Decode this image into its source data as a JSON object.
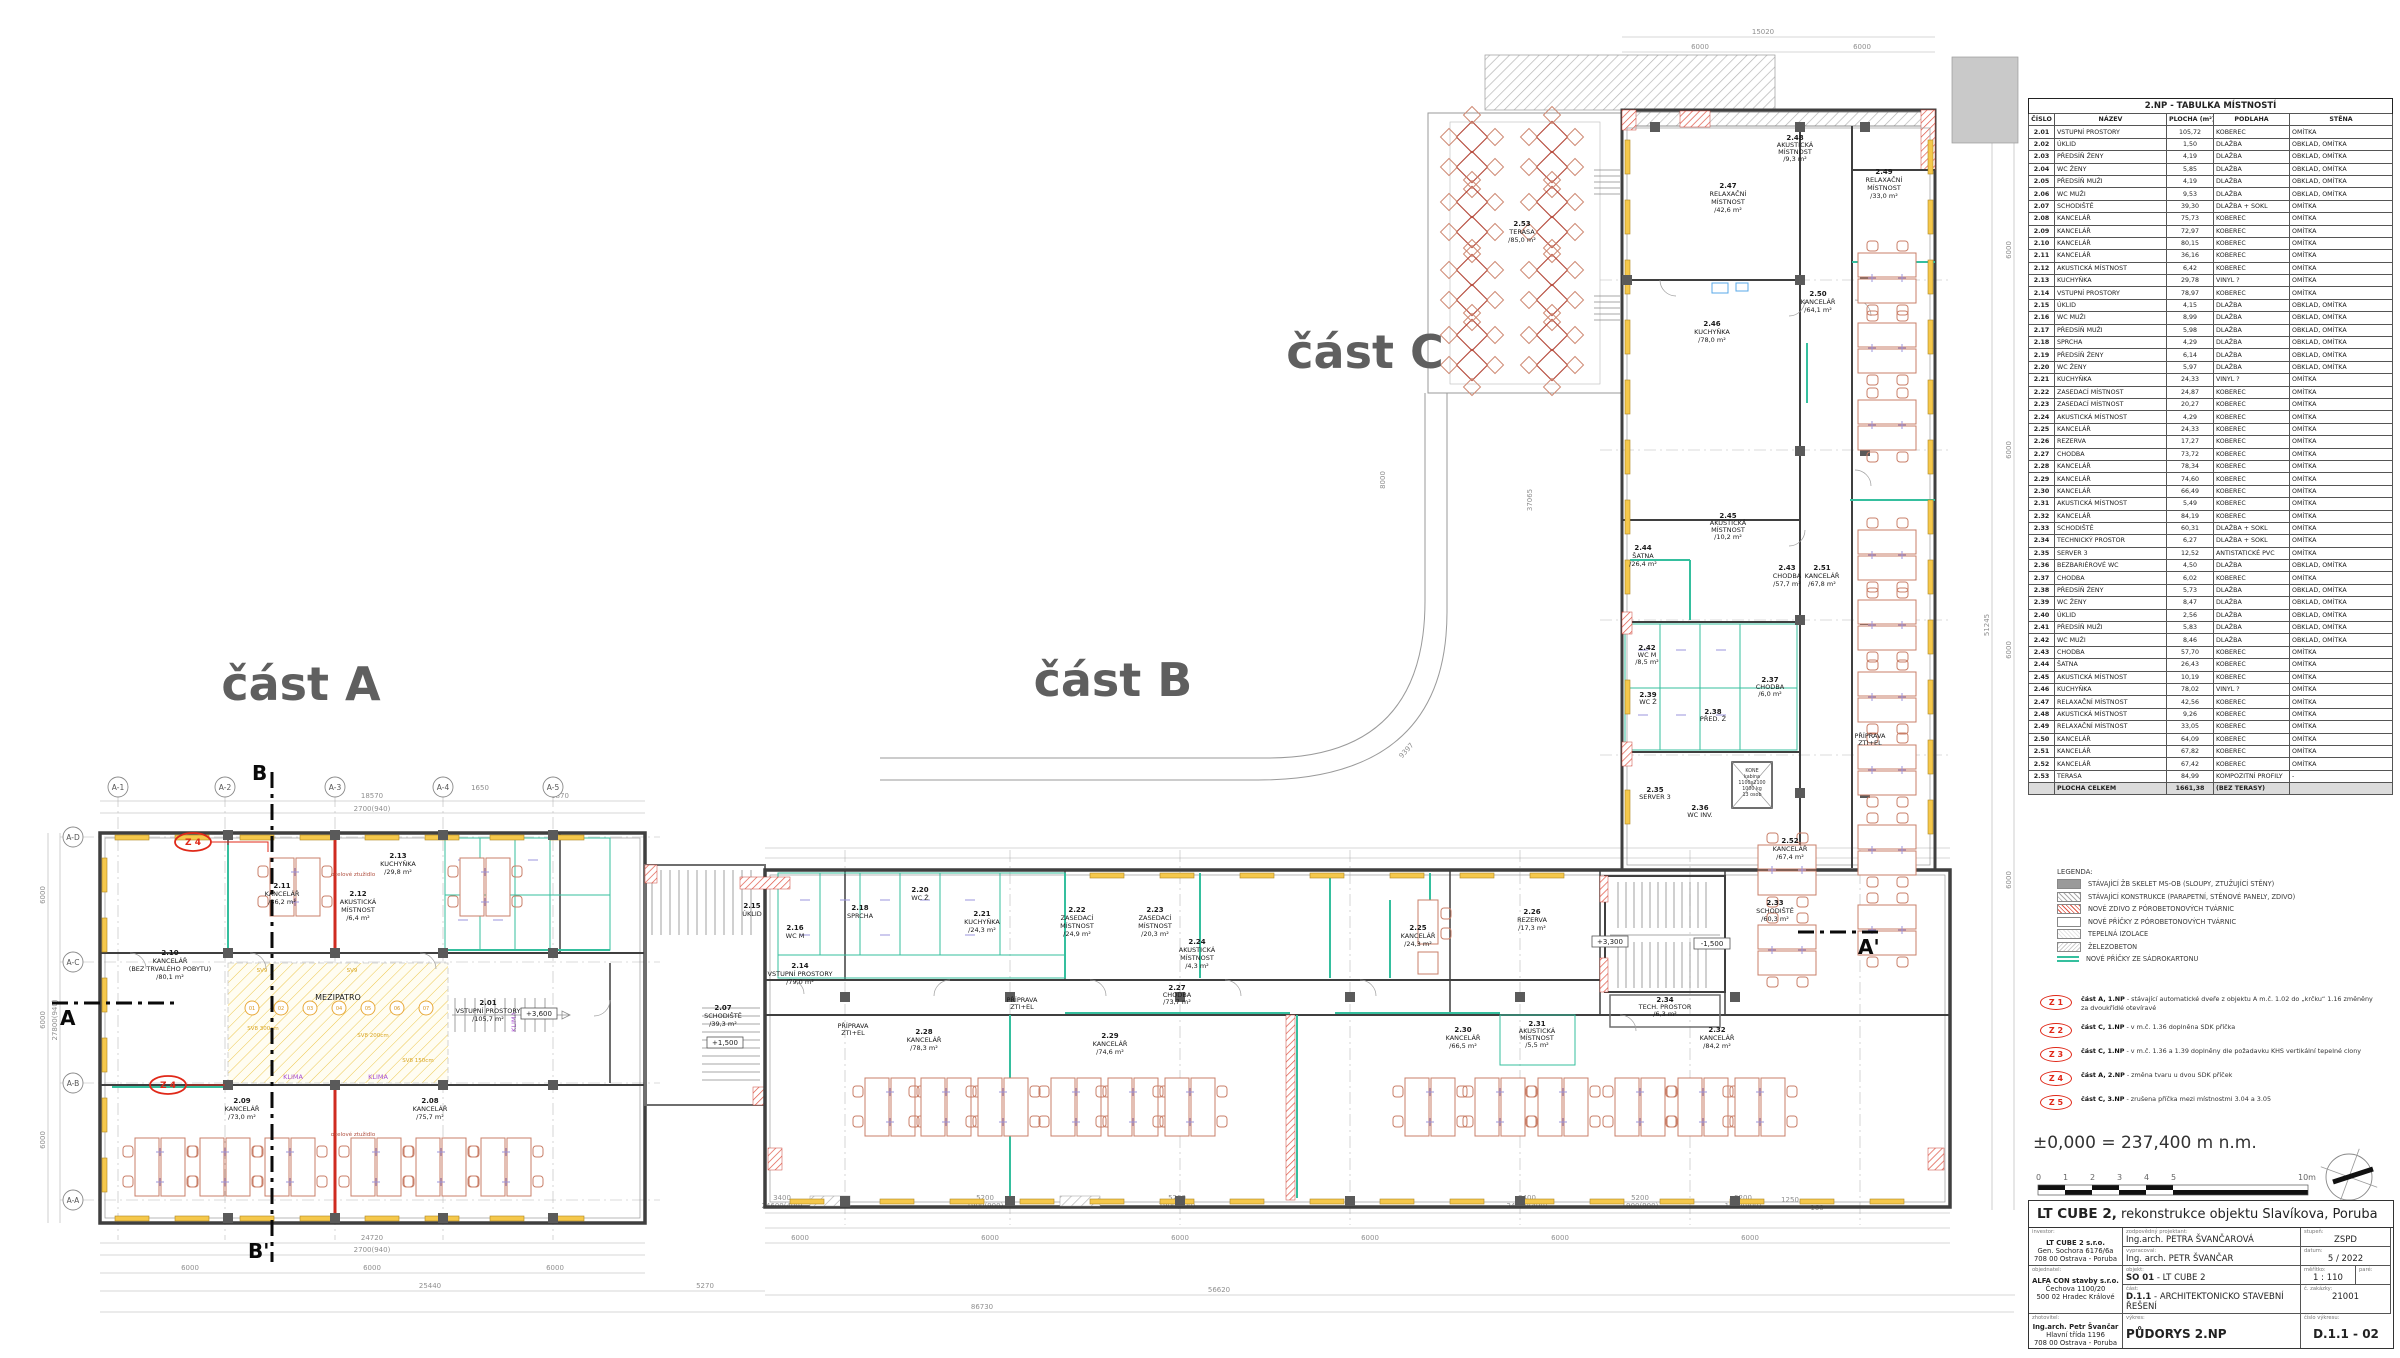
{
  "drawing_labels": {
    "part_a": "část A",
    "part_b": "část B",
    "part_c": "část C",
    "elevation_note": "±0,000 = 237,400 m n.m.",
    "section_a": "A",
    "section_a2": "A'",
    "section_b": "B",
    "section_b2": "B'",
    "level_3600": "+3,600",
    "level_1500": "+1,500",
    "level_3300": "+3,300",
    "level_m1500": "-1,500",
    "mezipatro": "MEZIPATRO",
    "klima": "KLIMA",
    "priprava1": "PŘÍPRAVA",
    "priprava2": "ZTI+EL",
    "steel_note": "ocelové ztužidlo",
    "kone": {
      "l1": "KONE",
      "l2": "kabina",
      "l3": "1100x2100",
      "l4": "1000 kg",
      "l5": "13 osob"
    }
  },
  "axes": {
    "top": [
      "A-1",
      "A-2",
      "A-3",
      "A-4",
      "A-5"
    ],
    "left": [
      "A-D",
      "A-C",
      "A-B",
      "A-A"
    ]
  },
  "dims": {
    "t1": "18570",
    "t2": "2700(940)",
    "t3": "6870",
    "t4": "1650",
    "l1": "27800(940)",
    "b1": "24720",
    "b2": "2700(940)",
    "six": "6000",
    "b3": "25440",
    "b4": "5270",
    "g1": "56620",
    "g2": "86730",
    "m1": "5200",
    "m2": "1900(900)",
    "m3": "3400",
    "m4": "24600(400)",
    "m5": "1250",
    "m6": "160",
    "c1": "15020",
    "c2": "51245",
    "r1": "8000",
    "r2": "37065",
    "r3": "9397"
  },
  "mez_nums": [
    "01",
    "02",
    "03",
    "04",
    "05",
    "06",
    "07"
  ],
  "sv_labels": [
    "SV9",
    "SV9",
    "SV8 150cm",
    "SV8 300cm",
    "SV8 200cm"
  ],
  "plan_rooms": {
    "r201": {
      "num": "2.01",
      "name": "VSTUPNÍ PROSTORY",
      "area": "/105,7 m²"
    },
    "r207": {
      "num": "2.07",
      "name": "SCHODIŠTĚ",
      "area": "/39,3 m²"
    },
    "r208": {
      "num": "2.08",
      "name": "KANCELÁŘ",
      "area": "/75,7 m²"
    },
    "r209": {
      "num": "2.09",
      "name": "KANCELÁŘ",
      "area": "/73,0 m²"
    },
    "r210": {
      "num": "2.10",
      "name": "KANCELÁŘ",
      "name2": "(BEZ TRVALÉHO POBYTU)",
      "area": "/80,1 m²"
    },
    "r211": {
      "num": "2.11",
      "name": "KANCELÁŘ",
      "area": "/36,2 m²"
    },
    "r212": {
      "num": "2.12",
      "name": "AKUSTICKÁ",
      "name2": "MÍSTNOST",
      "area": "/6,4 m²"
    },
    "r213": {
      "num": "2.13",
      "name": "KUCHYŇKA",
      "area": "/29,8 m²"
    },
    "r214": {
      "num": "2.14",
      "name": "VSTUPNÍ PROSTORY",
      "area": "/79,0 m²"
    },
    "r215": {
      "num": "2.15",
      "name": "ÚKLID"
    },
    "r216": {
      "num": "2.16",
      "name": "WC M",
      "area": "/9,0 m²"
    },
    "r218": {
      "num": "2.18",
      "name": "SPRCHA",
      "area": "/4,3 m²"
    },
    "r220": {
      "num": "2.20",
      "name": "WC Ž",
      "area": "/6,0 m²"
    },
    "r221": {
      "num": "2.21",
      "name": "KUCHYŇKA",
      "area": "/24,3 m²"
    },
    "r222": {
      "num": "2.22",
      "name": "ZASEDACÍ",
      "name2": "MÍSTNOST",
      "area": "/24,9 m²"
    },
    "r223": {
      "num": "2.23",
      "name": "ZASEDACÍ",
      "name2": "MÍSTNOST",
      "area": "/20,3 m²"
    },
    "r224": {
      "num": "2.24",
      "name": "AKUSTICKÁ",
      "name2": "MÍSTNOST",
      "area": "/4,3 m²"
    },
    "r225": {
      "num": "2.25",
      "name": "KANCELÁŘ",
      "area": "/24,3 m²"
    },
    "r226": {
      "num": "2.26",
      "name": "REZERVA",
      "area": "/17,3 m²"
    },
    "r227": {
      "num": "2.27",
      "name": "CHODBA",
      "area": "/73,7 m²"
    },
    "r228": {
      "num": "2.28",
      "name": "KANCELÁŘ",
      "area": "/78,3 m²"
    },
    "r229": {
      "num": "2.29",
      "name": "KANCELÁŘ",
      "area": "/74,6 m²"
    },
    "r230": {
      "num": "2.30",
      "name": "KANCELÁŘ",
      "area": "/66,5 m²"
    },
    "r231": {
      "num": "2.31",
      "name": "AKUSTICKÁ",
      "name2": "MÍSTNOST",
      "area": "/5,5 m²"
    },
    "r232": {
      "num": "2.32",
      "name": "KANCELÁŘ",
      "area": "/84,2 m²"
    },
    "r233": {
      "num": "2.33",
      "name": "SCHODIŠTĚ",
      "area": "/60,3 m²"
    },
    "r234": {
      "num": "2.34",
      "name": "TECH. PROSTOR",
      "area": "/6,3 m²"
    },
    "r235": {
      "num": "2.35",
      "name": "SERVER 3"
    },
    "r236": {
      "num": "2.36",
      "name": "WC INV."
    },
    "r237": {
      "num": "2.37",
      "name": "CHODBA",
      "area": "/6,0 m²"
    },
    "r238": {
      "num": "2.38",
      "name": "PŘED. Ž"
    },
    "r239": {
      "num": "2.39",
      "name": "WC Ž"
    },
    "r242": {
      "num": "2.42",
      "name": "WC M",
      "area": "/8,5 m²"
    },
    "r243": {
      "num": "2.43",
      "name": "CHODBA",
      "area": "/57,7 m²"
    },
    "r244": {
      "num": "2.44",
      "name": "ŠATNA",
      "area": "/26,4 m²"
    },
    "r245": {
      "num": "2.45",
      "name": "AKUSTICKÁ",
      "name2": "MÍSTNOST",
      "area": "/10,2 m²"
    },
    "r246": {
      "num": "2.46",
      "name": "KUCHYŇKA",
      "area": "/78,0 m²"
    },
    "r247": {
      "num": "2.47",
      "name": "RELAXAČNÍ",
      "name2": "MÍSTNOST",
      "area": "/42,6 m²"
    },
    "r248": {
      "num": "2.48",
      "name": "AKUSTICKÁ",
      "name2": "MÍSTNOST",
      "area": "/9,3 m²"
    },
    "r249": {
      "num": "2.49",
      "name": "RELAXAČNÍ",
      "name2": "MÍSTNOST",
      "area": "/33,0 m²"
    },
    "r250": {
      "num": "2.50",
      "name": "KANCELÁŘ",
      "area": "/64,1 m²"
    },
    "r251": {
      "num": "2.51",
      "name": "KANCELÁŘ",
      "area": "/67,8 m²"
    },
    "r252": {
      "num": "2.52",
      "name": "KANCELÁŘ",
      "area": "/67,4 m²"
    },
    "r253": {
      "num": "2.53",
      "name": "TERASA",
      "area": "/85,0 m²"
    }
  },
  "room_table": {
    "title": "2.NP - TABULKA MÍSTNOSTÍ",
    "headers": [
      "ČÍSLO",
      "NÁZEV",
      "PLOCHA (m²)",
      "PODLAHA",
      "STĚNA"
    ],
    "rows": [
      [
        "2.01",
        "VSTUPNÍ PROSTORY",
        "105,72",
        "KOBEREC",
        "OMÍTKA"
      ],
      [
        "2.02",
        "ÚKLID",
        "1,50",
        "DLAŽBA",
        "OBKLAD, OMÍTKA"
      ],
      [
        "2.03",
        "PŘEDSÍŇ ŽENY",
        "4,19",
        "DLAŽBA",
        "OBKLAD, OMÍTKA"
      ],
      [
        "2.04",
        "WC ŽENY",
        "5,85",
        "DLAŽBA",
        "OBKLAD, OMÍTKA"
      ],
      [
        "2.05",
        "PŘEDSÍŇ MUŽI",
        "4,19",
        "DLAŽBA",
        "OBKLAD, OMÍTKA"
      ],
      [
        "2.06",
        "WC MUŽI",
        "9,53",
        "DLAŽBA",
        "OBKLAD, OMÍTKA"
      ],
      [
        "2.07",
        "SCHODIŠTĚ",
        "39,30",
        "DLAŽBA + SOKL",
        "OMÍTKA"
      ],
      [
        "2.08",
        "KANCELÁŘ",
        "75,73",
        "KOBEREC",
        "OMÍTKA"
      ],
      [
        "2.09",
        "KANCELÁŘ",
        "72,97",
        "KOBEREC",
        "OMÍTKA"
      ],
      [
        "2.10",
        "KANCELÁŘ",
        "80,15",
        "KOBEREC",
        "OMÍTKA"
      ],
      [
        "2.11",
        "KANCELÁŘ",
        "36,16",
        "KOBEREC",
        "OMÍTKA"
      ],
      [
        "2.12",
        "AKUSTICKÁ MÍSTNOST",
        "6,42",
        "KOBEREC",
        "OMÍTKA"
      ],
      [
        "2.13",
        "KUCHYŇKA",
        "29,78",
        "VINYL ?",
        "OMÍTKA"
      ],
      [
        "2.14",
        "VSTUPNÍ PROSTORY",
        "78,97",
        "KOBEREC",
        "OMÍTKA"
      ],
      [
        "2.15",
        "ÚKLID",
        "4,15",
        "DLAŽBA",
        "OBKLAD, OMÍTKA"
      ],
      [
        "2.16",
        "WC MUŽI",
        "8,99",
        "DLAŽBA",
        "OBKLAD, OMÍTKA"
      ],
      [
        "2.17",
        "PŘEDSÍŇ MUŽI",
        "5,98",
        "DLAŽBA",
        "OBKLAD, OMÍTKA"
      ],
      [
        "2.18",
        "SPRCHA",
        "4,29",
        "DLAŽBA",
        "OBKLAD, OMÍTKA"
      ],
      [
        "2.19",
        "PŘEDSÍŇ ŽENY",
        "6,14",
        "DLAŽBA",
        "OBKLAD, OMÍTKA"
      ],
      [
        "2.20",
        "WC ŽENY",
        "5,97",
        "DLAŽBA",
        "OBKLAD, OMÍTKA"
      ],
      [
        "2.21",
        "KUCHYŇKA",
        "24,33",
        "VINYL ?",
        "OMÍTKA"
      ],
      [
        "2.22",
        "ZASEDACÍ MÍSTNOST",
        "24,87",
        "KOBEREC",
        "OMÍTKA"
      ],
      [
        "2.23",
        "ZASEDACÍ MÍSTNOST",
        "20,27",
        "KOBEREC",
        "OMÍTKA"
      ],
      [
        "2.24",
        "AKUSTICKÁ MÍSTNOST",
        "4,29",
        "KOBEREC",
        "OMÍTKA"
      ],
      [
        "2.25",
        "KANCELÁŘ",
        "24,33",
        "KOBEREC",
        "OMÍTKA"
      ],
      [
        "2.26",
        "REZERVA",
        "17,27",
        "KOBEREC",
        "OMÍTKA"
      ],
      [
        "2.27",
        "CHODBA",
        "73,72",
        "KOBEREC",
        "OMÍTKA"
      ],
      [
        "2.28",
        "KANCELÁŘ",
        "78,34",
        "KOBEREC",
        "OMÍTKA"
      ],
      [
        "2.29",
        "KANCELÁŘ",
        "74,60",
        "KOBEREC",
        "OMÍTKA"
      ],
      [
        "2.30",
        "KANCELÁŘ",
        "66,49",
        "KOBEREC",
        "OMÍTKA"
      ],
      [
        "2.31",
        "AKUSTICKÁ MÍSTNOST",
        "5,49",
        "KOBEREC",
        "OMÍTKA"
      ],
      [
        "2.32",
        "KANCELÁŘ",
        "84,19",
        "KOBEREC",
        "OMÍTKA"
      ],
      [
        "2.33",
        "SCHODIŠTĚ",
        "60,31",
        "DLAŽBA + SOKL",
        "OMÍTKA"
      ],
      [
        "2.34",
        "TECHNICKÝ PROSTOR",
        "6,27",
        "DLAŽBA + SOKL",
        "OMÍTKA"
      ],
      [
        "2.35",
        "SERVER 3",
        "12,52",
        "ANTISTATICKÉ PVC",
        "OMÍTKA"
      ],
      [
        "2.36",
        "BEZBARIÉROVÉ WC",
        "4,50",
        "DLAŽBA",
        "OBKLAD, OMÍTKA"
      ],
      [
        "2.37",
        "CHODBA",
        "6,02",
        "KOBEREC",
        "OMÍTKA"
      ],
      [
        "2.38",
        "PŘEDSÍŇ ŽENY",
        "5,73",
        "DLAŽBA",
        "OBKLAD, OMÍTKA"
      ],
      [
        "2.39",
        "WC ŽENY",
        "8,47",
        "DLAŽBA",
        "OBKLAD, OMÍTKA"
      ],
      [
        "2.40",
        "ÚKLID",
        "2,56",
        "DLAŽBA",
        "OBKLAD, OMÍTKA"
      ],
      [
        "2.41",
        "PŘEDSÍŇ MUŽI",
        "5,83",
        "DLAŽBA",
        "OBKLAD, OMÍTKA"
      ],
      [
        "2.42",
        "WC MUŽI",
        "8,46",
        "DLAŽBA",
        "OBKLAD, OMÍTKA"
      ],
      [
        "2.43",
        "CHODBA",
        "57,70",
        "KOBEREC",
        "OMÍTKA"
      ],
      [
        "2.44",
        "ŠATNA",
        "26,43",
        "KOBEREC",
        "OMÍTKA"
      ],
      [
        "2.45",
        "AKUSTICKÁ MÍSTNOST",
        "10,19",
        "KOBEREC",
        "OMÍTKA"
      ],
      [
        "2.46",
        "KUCHYŇKA",
        "78,02",
        "VINYL ?",
        "OMÍTKA"
      ],
      [
        "2.47",
        "RELAXAČNÍ MÍSTNOST",
        "42,56",
        "KOBEREC",
        "OMÍTKA"
      ],
      [
        "2.48",
        "AKUSTICKÁ MÍSTNOST",
        "9,26",
        "KOBEREC",
        "OMÍTKA"
      ],
      [
        "2.49",
        "RELAXAČNÍ MÍSTNOST",
        "33,05",
        "KOBEREC",
        "OMÍTKA"
      ],
      [
        "2.50",
        "KANCELÁŘ",
        "64,09",
        "KOBEREC",
        "OMÍTKA"
      ],
      [
        "2.51",
        "KANCELÁŘ",
        "67,82",
        "KOBEREC",
        "OMÍTKA"
      ],
      [
        "2.52",
        "KANCELÁŘ",
        "67,42",
        "KOBEREC",
        "OMÍTKA"
      ],
      [
        "2.53",
        "TERASA",
        "84,99",
        "KOMPOZITNÍ PROFILY",
        "-"
      ]
    ],
    "total": {
      "label": "PLOCHA CELKEM",
      "area": "1661,38",
      "floor": "(BEZ TERASY)",
      "wall": ""
    }
  },
  "legend": {
    "title": "LEGENDA:",
    "items": [
      "STÁVAJÍCÍ ŽB SKELET MS-OB (SLOUPY, ZTUŽUJÍCÍ STĚNY)",
      "STÁVAJÍCÍ KONSTRUKCE (PARAPETNÍ, STĚNOVÉ PANELY, ZDIVO)",
      "NOVÉ ZDIVO Z PÓROBETONOVÝCH TVÁRNIC",
      "NOVÉ PŘÍČKY Z PÓROBETONOVÝCH TVÁRNIC",
      "TEPELNÁ IZOLACE",
      "ŽELEZOBETON",
      "NOVÉ PŘÍČKY ZE SÁDROKARTONU"
    ]
  },
  "changes": [
    {
      "code": "Z 1",
      "lead": "část A, 1.NP",
      "text": " - stávající automatické dveře z objektu A m.č. 1.02 do „krčku“ 1.16 změněny za dvoukřídlé otevíravé"
    },
    {
      "code": "Z 2",
      "lead": "část C, 1.NP",
      "text": " - v m.č. 1.36 doplněna SDK příčka"
    },
    {
      "code": "Z 3",
      "lead": "část C, 1.NP",
      "text": " - v m.č. 1.36 a 1.39 doplněny dle požadavku KHS vertikální tepelné clony"
    },
    {
      "code": "Z 4",
      "lead": "část A, 2.NP",
      "text": " - změna tvaru  u dvou SDK příček"
    },
    {
      "code": "Z 5",
      "lead": "část C, 3.NP",
      "text": " - zrušena příčka mezi místnostmi 3.04 a 3.05"
    }
  ],
  "change_marker": "Z 4",
  "scalebar": {
    "labels": [
      "0",
      "1",
      "2",
      "3",
      "4",
      "5",
      "10m"
    ]
  },
  "titleblock": {
    "header_bold": "LT CUBE 2,",
    "header_rest": " rekonstrukce objektu Slavíkova, Poruba",
    "investor_label": "investor:",
    "investor1": "LT CUBE 2 s.r.o.",
    "investor2": "Gen. Sochora 6176/6a",
    "investor3": "708 00 Ostrava - Poruba",
    "designer_label": "zodpovědný projektant:",
    "designer": "Ing.arch. PETRA ŠVANČAROVÁ",
    "drawnby_label": "vypracoval:",
    "drawnby": "Ing. arch. PETR ŠVANČAR",
    "stage_label": "stupeň:",
    "stage": "ZSPD",
    "date_label": "datum:",
    "date": "5 / 2022",
    "client_label": "objednatel:",
    "client1": "ALFA CON stavby s.r.o.",
    "client2": "Čechova 1100/20",
    "client3": "500 02 Hradec Králové",
    "object_label": "objekt:",
    "object_bold": "SO 01",
    "object_rest": " - LT CUBE 2",
    "scale_label": "měřítko:",
    "scale": "1 : 110",
    "pare_label": "paré:",
    "part_label": "část:",
    "part_bold": "D.1.1",
    "part_rest": " - ARCHITEKTONICKO STAVEBNÍ ŘEŠENÍ",
    "order_label": "č. zakázky:",
    "order": "21001",
    "contractor_label": "zhotovitel:",
    "contractor1": "Ing.arch. Petr Švančar",
    "contractor2": "Hlavní třída 1196",
    "contractor3": "708 00 Ostrava - Poruba",
    "drawing_label": "výkres:",
    "drawing": "PŮDORYS 2.NP",
    "number_label": "číslo výkresu:",
    "number": "D.1.1 - 02"
  }
}
